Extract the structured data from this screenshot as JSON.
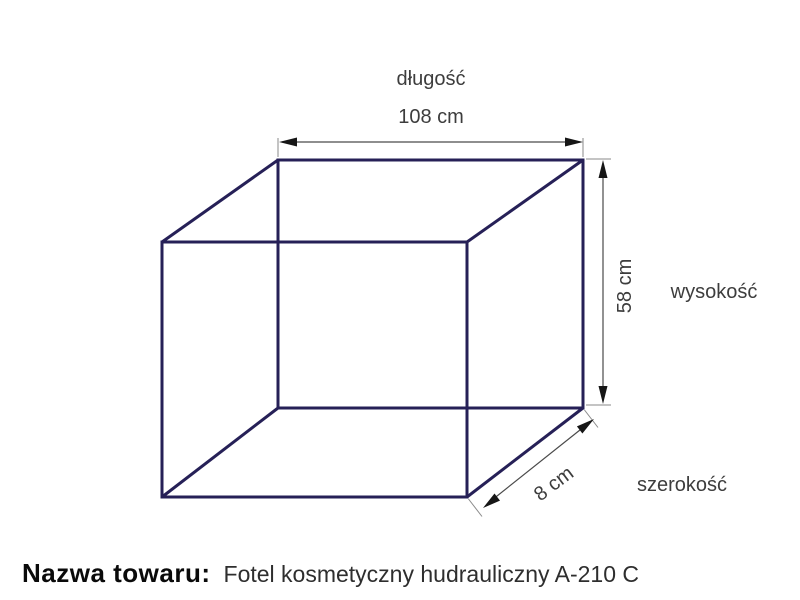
{
  "diagram": {
    "length": {
      "label": "długość",
      "value": "108 cm"
    },
    "height": {
      "label": "wysokość",
      "value": "58 cm"
    },
    "width": {
      "label": "szerokość",
      "value": "8 cm"
    },
    "colors": {
      "box_line": "#262057",
      "dimension_line": "#4a4a4a",
      "arrowhead": "#161616",
      "label_text": "#3d3d3d",
      "footer_label_text": "#0a0a0a",
      "footer_value_text": "#2e2e2e",
      "background": "#ffffff"
    }
  },
  "footer": {
    "name_label": "Nazwa towaru:",
    "name_value": "Fotel kosmetyczny hudrauliczny A-210 C"
  }
}
